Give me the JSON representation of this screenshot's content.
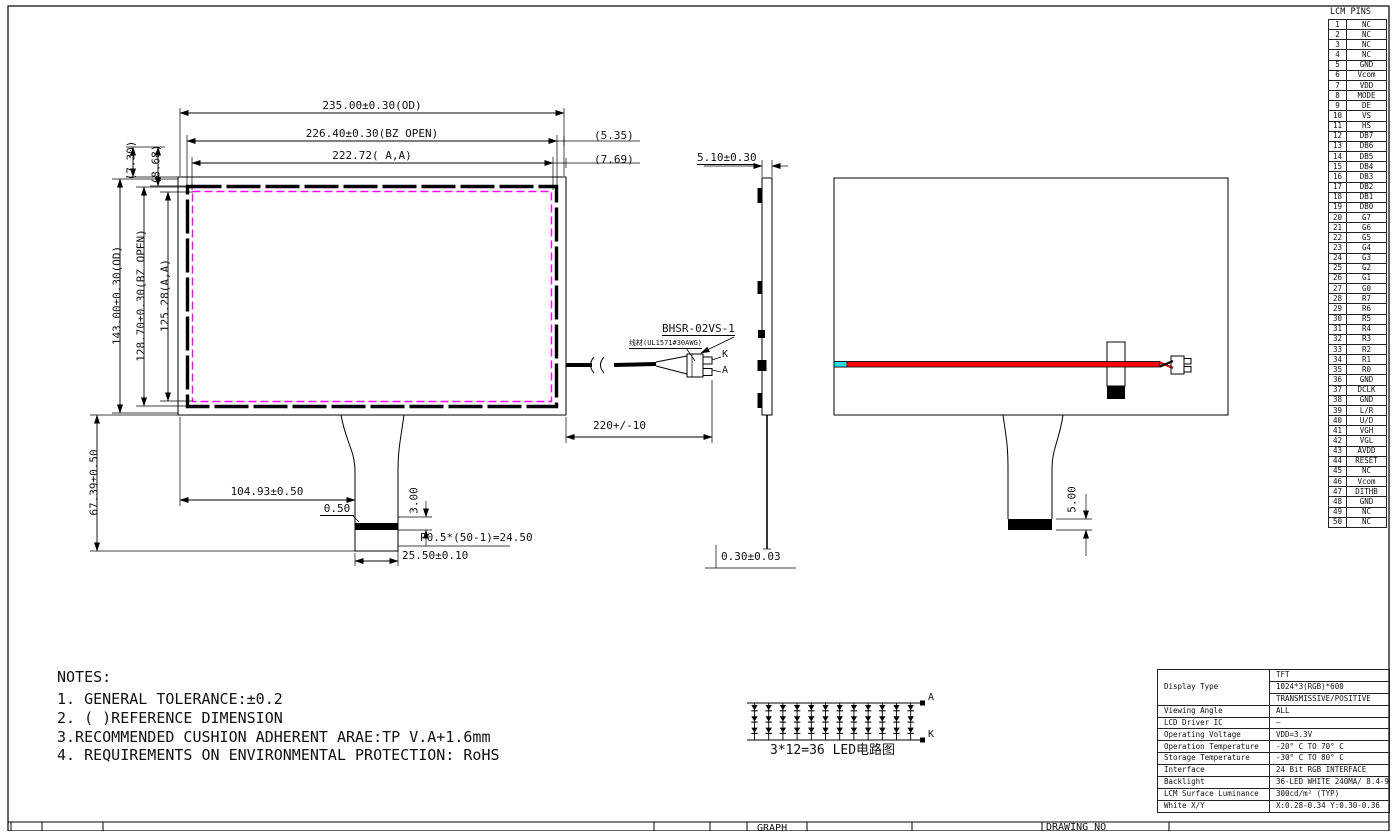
{
  "drawing": {
    "dims": {
      "od_width": "235.00±0.30(OD)",
      "bz_width": "226.40±0.30(BZ OPEN)",
      "aa_width": "222.72( A,A)",
      "right_ref_1": "(5.35)",
      "right_ref_2": "(7.69)",
      "top_left_ref_1": "(7.30)",
      "top_left_ref_2": "(8.68)",
      "od_height": "143.00±0.30(OD)",
      "bz_height": "128.70±0.30(BZ OPEN)",
      "aa_height": "125.28(A,A)",
      "fpc_bottom_offset": "67.39±0.50",
      "fpc_center_x": "104.93±0.50",
      "stiffener_inset": "0.50",
      "stiffener_height": "3.00",
      "pin_pitch": "P0.5*(50-1)=24.50",
      "fpc_width": "25.50±0.10",
      "module_thickness": "5.10±0.30",
      "cable_length": "220+/-10",
      "fpc_thickness": "0.30±0.03",
      "rear_stiffener_height": "5.00"
    },
    "connector": {
      "part_no": "BHSR-02VS-1",
      "wire_spec": "线材(UL1571#30AWG)",
      "pin_k": "K",
      "pin_a": "A"
    }
  },
  "led_circuit": {
    "caption": "3*12=36 LED电路图",
    "anode_label": "A",
    "cathode_label": "K",
    "rows": 3,
    "cols": 12
  },
  "notes": {
    "title": "NOTES:",
    "lines": [
      "1. GENERAL TOLERANCE:±0.2",
      "2. ( )REFERENCE DIMENSION",
      "3.RECOMMENDED CUSHION ADHERENT ARAE:TP V.A+1.6mm",
      "4. REQUIREMENTS ON ENVIRONMENTAL PROTECTION: RoHS"
    ]
  },
  "lcm_pins": {
    "title": "LCM PINS",
    "pins": [
      [
        "1",
        "NC"
      ],
      [
        "2",
        "NC"
      ],
      [
        "3",
        "NC"
      ],
      [
        "4",
        "NC"
      ],
      [
        "5",
        "GND"
      ],
      [
        "6",
        "Vcom"
      ],
      [
        "7",
        "VDD"
      ],
      [
        "8",
        "MODE"
      ],
      [
        "9",
        "DE"
      ],
      [
        "10",
        "VS"
      ],
      [
        "11",
        "HS"
      ],
      [
        "12",
        "DB7"
      ],
      [
        "13",
        "DB6"
      ],
      [
        "14",
        "DB5"
      ],
      [
        "15",
        "DB4"
      ],
      [
        "16",
        "DB3"
      ],
      [
        "17",
        "DB2"
      ],
      [
        "18",
        "DB1"
      ],
      [
        "19",
        "DB0"
      ],
      [
        "20",
        "G7"
      ],
      [
        "21",
        "G6"
      ],
      [
        "22",
        "G5"
      ],
      [
        "23",
        "G4"
      ],
      [
        "24",
        "G3"
      ],
      [
        "25",
        "G2"
      ],
      [
        "26",
        "G1"
      ],
      [
        "27",
        "G0"
      ],
      [
        "28",
        "R7"
      ],
      [
        "29",
        "R6"
      ],
      [
        "30",
        "R5"
      ],
      [
        "31",
        "R4"
      ],
      [
        "32",
        "R3"
      ],
      [
        "33",
        "R2"
      ],
      [
        "34",
        "R1"
      ],
      [
        "35",
        "R0"
      ],
      [
        "36",
        "GND"
      ],
      [
        "37",
        "DCLK"
      ],
      [
        "38",
        "GND"
      ],
      [
        "39",
        "L/R"
      ],
      [
        "40",
        "U/D"
      ],
      [
        "41",
        "VGH"
      ],
      [
        "42",
        "VGL"
      ],
      [
        "43",
        "AVDD"
      ],
      [
        "44",
        "RESET"
      ],
      [
        "45",
        "NC"
      ],
      [
        "46",
        "Vcom"
      ],
      [
        "47",
        "DITHB"
      ],
      [
        "48",
        "GND"
      ],
      [
        "49",
        "NC"
      ],
      [
        "50",
        "NC"
      ]
    ]
  },
  "spec_table": {
    "rows": [
      {
        "label": "Display Type",
        "values": [
          "TFT",
          "1024*3(RGB)*600",
          "TRANSMISSIVE/POSITIVE"
        ]
      },
      {
        "label": "Viewing Angle",
        "value": "ALL"
      },
      {
        "label": "LCD Driver IC",
        "value": "—"
      },
      {
        "label": "Operating Voltage",
        "value": "VDD=3.3V"
      },
      {
        "label": "Operation Temperature",
        "value": "-20° C TO 70° C"
      },
      {
        "label": "Storage Temperature",
        "value": "-30° C TO 80° C"
      },
      {
        "label": "Interface",
        "value": "24 Bit RGB INTERFACE"
      },
      {
        "label": "Backlight",
        "value": "36-LED WHITE 240MA/ 8.4-9.6V"
      },
      {
        "label": "LCM Surface Luminance",
        "value": "300cd/m² (TYP)"
      },
      {
        "label": "White X/Y",
        "value": "X:0.28-0.34  Y:0.30-0.36"
      }
    ]
  },
  "title_block": {
    "graph_label": "GRAPH",
    "drawing_no_label": "DRAWING NO"
  },
  "colors": {
    "active_area": "#ff00ff",
    "backlight_wire": "#ff0000",
    "wire_tip": "#22dde6"
  }
}
